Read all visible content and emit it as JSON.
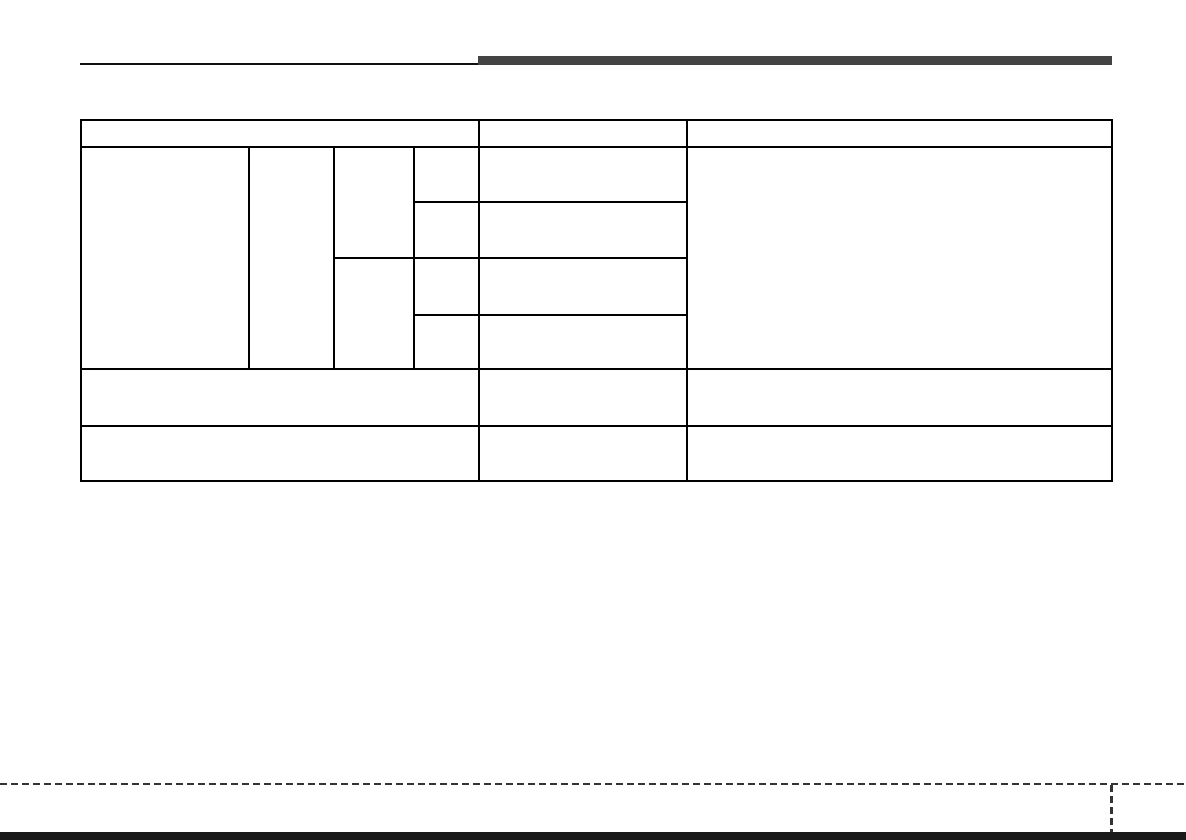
{
  "colors": {
    "page_background": "#ffffff",
    "table_border": "#000000",
    "header_thin_rule": "#111111",
    "header_accent_bar": "#434343",
    "footer_dash": "#333333",
    "page_bottom_edge": "#1a1a1a"
  },
  "table": {
    "header_cells": [
      "",
      "",
      ""
    ],
    "main_row": {
      "col1": "",
      "col2": "",
      "col3": [
        "",
        ""
      ],
      "col4": [
        "",
        "",
        "",
        ""
      ],
      "col5": [
        "",
        "",
        "",
        ""
      ],
      "col6": ""
    },
    "row2": [
      "",
      "",
      ""
    ],
    "row3": [
      "",
      "",
      ""
    ]
  }
}
